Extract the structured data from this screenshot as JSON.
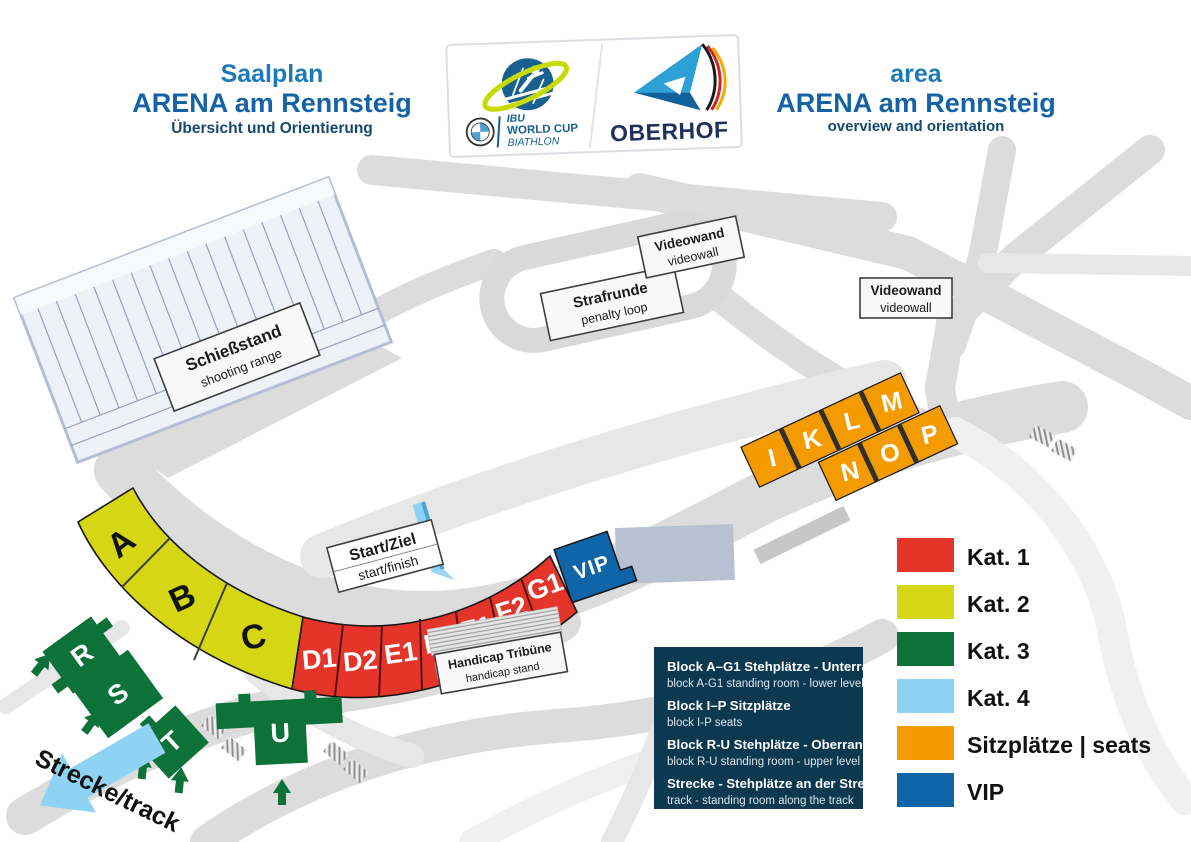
{
  "header": {
    "title_left": {
      "line1": "Saalplan",
      "line2": "ARENA am Rennsteig",
      "line3": "Übersicht und Orientierung"
    },
    "title_right": {
      "line1": "area",
      "line2": "ARENA am Rennsteig",
      "line3": "overview and orientation"
    },
    "logo_ibu": {
      "line1": "IBU",
      "line2": "WORLD CUP",
      "line3": "BIATHLON"
    },
    "logo_oberhof": {
      "name": "OBERHOF"
    }
  },
  "map": {
    "shooting_range": {
      "de": "Schießstand",
      "en": "shooting range"
    },
    "penalty_loop": {
      "de": "Strafrunde",
      "en": "penalty loop"
    },
    "videowall_top": {
      "de": "Videowand",
      "en": "videowall"
    },
    "videowall_right": {
      "de": "Videowand",
      "en": "videowall"
    },
    "start_finish": {
      "de": "Start/Ziel",
      "en": "start/finish"
    },
    "handicap": {
      "de": "Handicap Tribüne",
      "en": "handicap stand"
    },
    "track_arrow_label": "Strecke/track",
    "blocks_kat2": [
      "A",
      "B",
      "C"
    ],
    "blocks_kat1": [
      "D1",
      "D2",
      "E1",
      "E2",
      "F1",
      "F2",
      "G1"
    ],
    "block_vip": "VIP",
    "blocks_seats_upper": [
      "I",
      "K",
      "L",
      "M"
    ],
    "blocks_seats_lower": [
      "N",
      "O",
      "P"
    ],
    "blocks_kat3": [
      "R",
      "S",
      "T",
      "U"
    ]
  },
  "legend": {
    "items": [
      {
        "label": "Kat. 1",
        "color": "#e5352b"
      },
      {
        "label": "Kat. 2",
        "color": "#d5d714"
      },
      {
        "label": "Kat. 3",
        "color": "#0c7239"
      },
      {
        "label": "Kat. 4",
        "color": "#8ed3f3"
      },
      {
        "label": "Sitzplätze | seats",
        "color": "#f49b00"
      },
      {
        "label": "VIP",
        "color": "#1065a9"
      }
    ]
  },
  "info_box": {
    "rows": [
      {
        "de": "Block A–G1 Stehplätze - Unterrang",
        "en": "block A-G1 standing room - lower level"
      },
      {
        "de": "Block I–P Sitzplätze",
        "en": "block I-P seats"
      },
      {
        "de": "Block R-U Stehplätze - Oberrang",
        "en": "block R-U standing room - upper level"
      },
      {
        "de": "Strecke - Stehplätze an der Strecke",
        "en": "track - standing room along the track"
      }
    ]
  }
}
